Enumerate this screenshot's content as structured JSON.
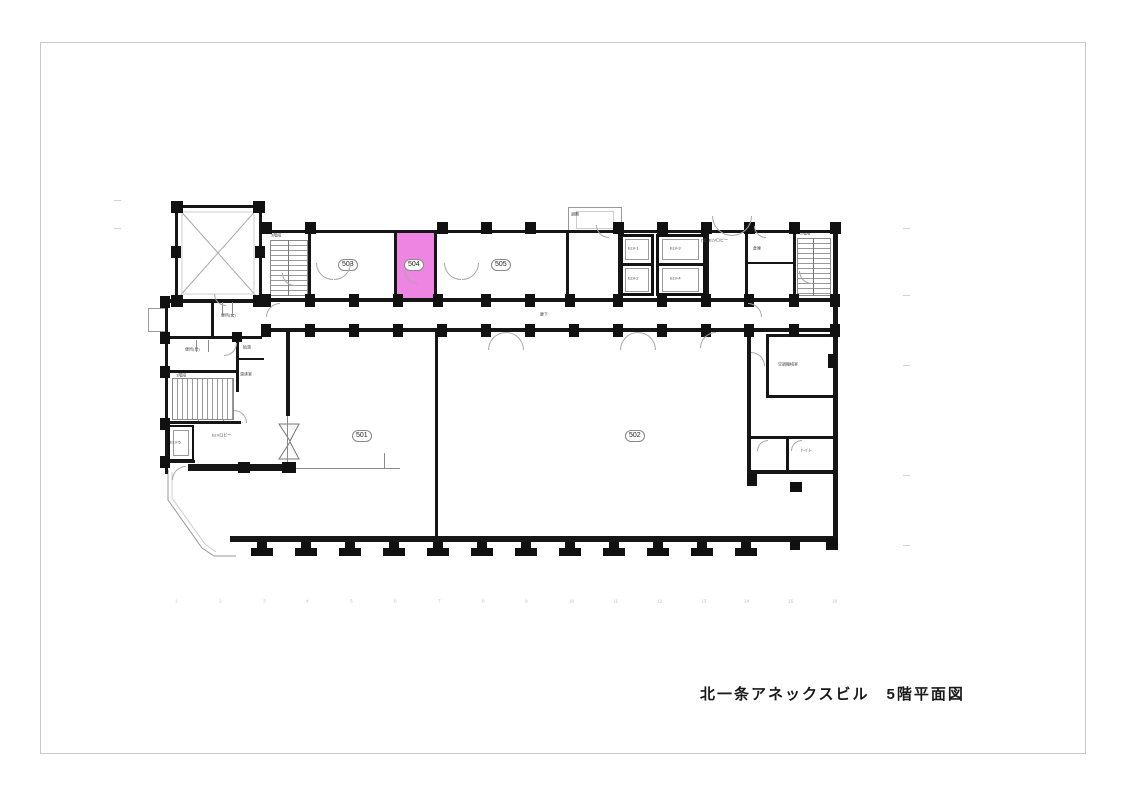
{
  "drawing": {
    "title": "北一条アネックスビル　5階平面図"
  },
  "colors": {
    "highlight": "#ee85e2",
    "wall": "#161616",
    "frame": "#c8c8c8"
  },
  "rooms": {
    "n501": "501",
    "n502": "502",
    "n503": "503",
    "n504": "504",
    "n505": "505"
  },
  "labels": {
    "corridor": "廊下",
    "stair1": "1階段",
    "stair2": "2階段",
    "stair3": "3階段",
    "elv_lobby": "ELVロビー",
    "elv_lobby_temp": "(仮) ELVロビー",
    "machine_room": "空調機械室",
    "wc_women": "便所(女)",
    "wc_men": "便所(男)",
    "kyuto": "給湯",
    "yuwakashi": "湯沸室",
    "safe": "金庫",
    "elv1": "ELV-1",
    "elv2": "ELV-2",
    "elv3": "ELV-3",
    "elv4": "ELV-4",
    "elv5": "ELV-5",
    "evacuation": "避難",
    "toilet": "トイレ",
    "storage": "倉庫"
  },
  "grid": {
    "x_numbers": [
      "1",
      "2",
      "3",
      "4",
      "5",
      "6",
      "7",
      "8",
      "9",
      "10",
      "11",
      "12",
      "13",
      "14",
      "15",
      "16"
    ]
  }
}
